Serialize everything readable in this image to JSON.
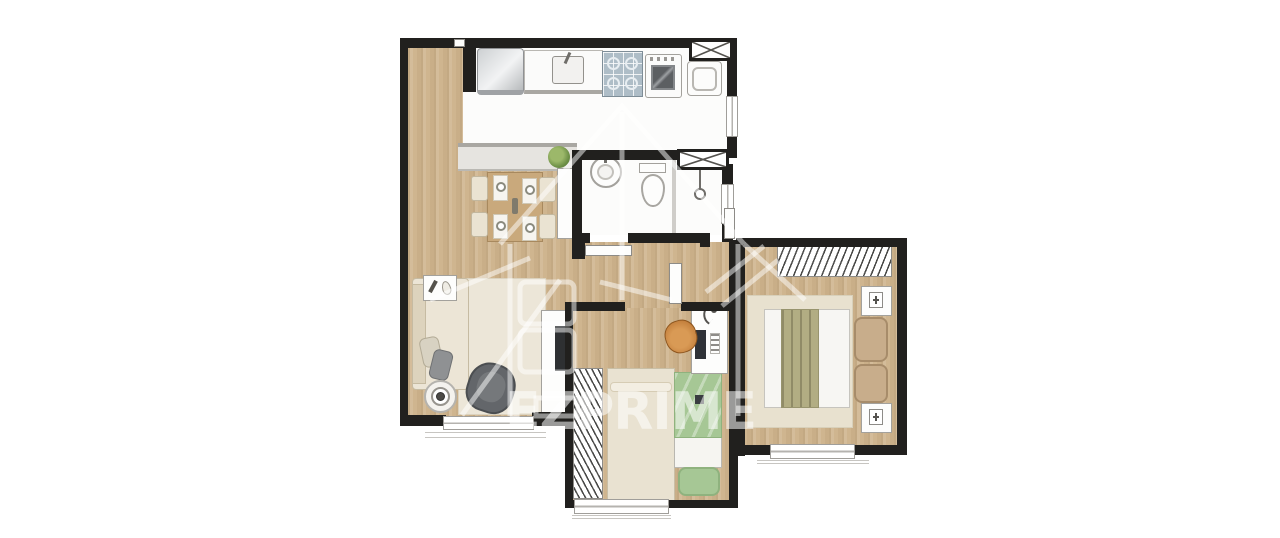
{
  "watermark": {
    "text": "EZPRIME"
  },
  "palette": {
    "wall": "#21201e",
    "wood": "#cfb58f",
    "floor_white": "#fcfcfb",
    "beige": "#eae3d2",
    "beige_dark": "#d9cfb8",
    "tan": "#c9a97c",
    "green": "#a6c795",
    "green_dark": "#8fb27e",
    "olive": "#b2ad83",
    "gray_chair": "#63666a",
    "orange": "#c4803d",
    "line_gray": "#9b9995",
    "watermark": "rgba(255,255,255,0.55)"
  },
  "icons": {
    "window-x-icon": "box with X cross",
    "shower-head-icon": "drop line with circle",
    "lamp-icon": "hook with dot",
    "plant-icon": "green circle",
    "plate-icon": "white circle on placemat"
  }
}
